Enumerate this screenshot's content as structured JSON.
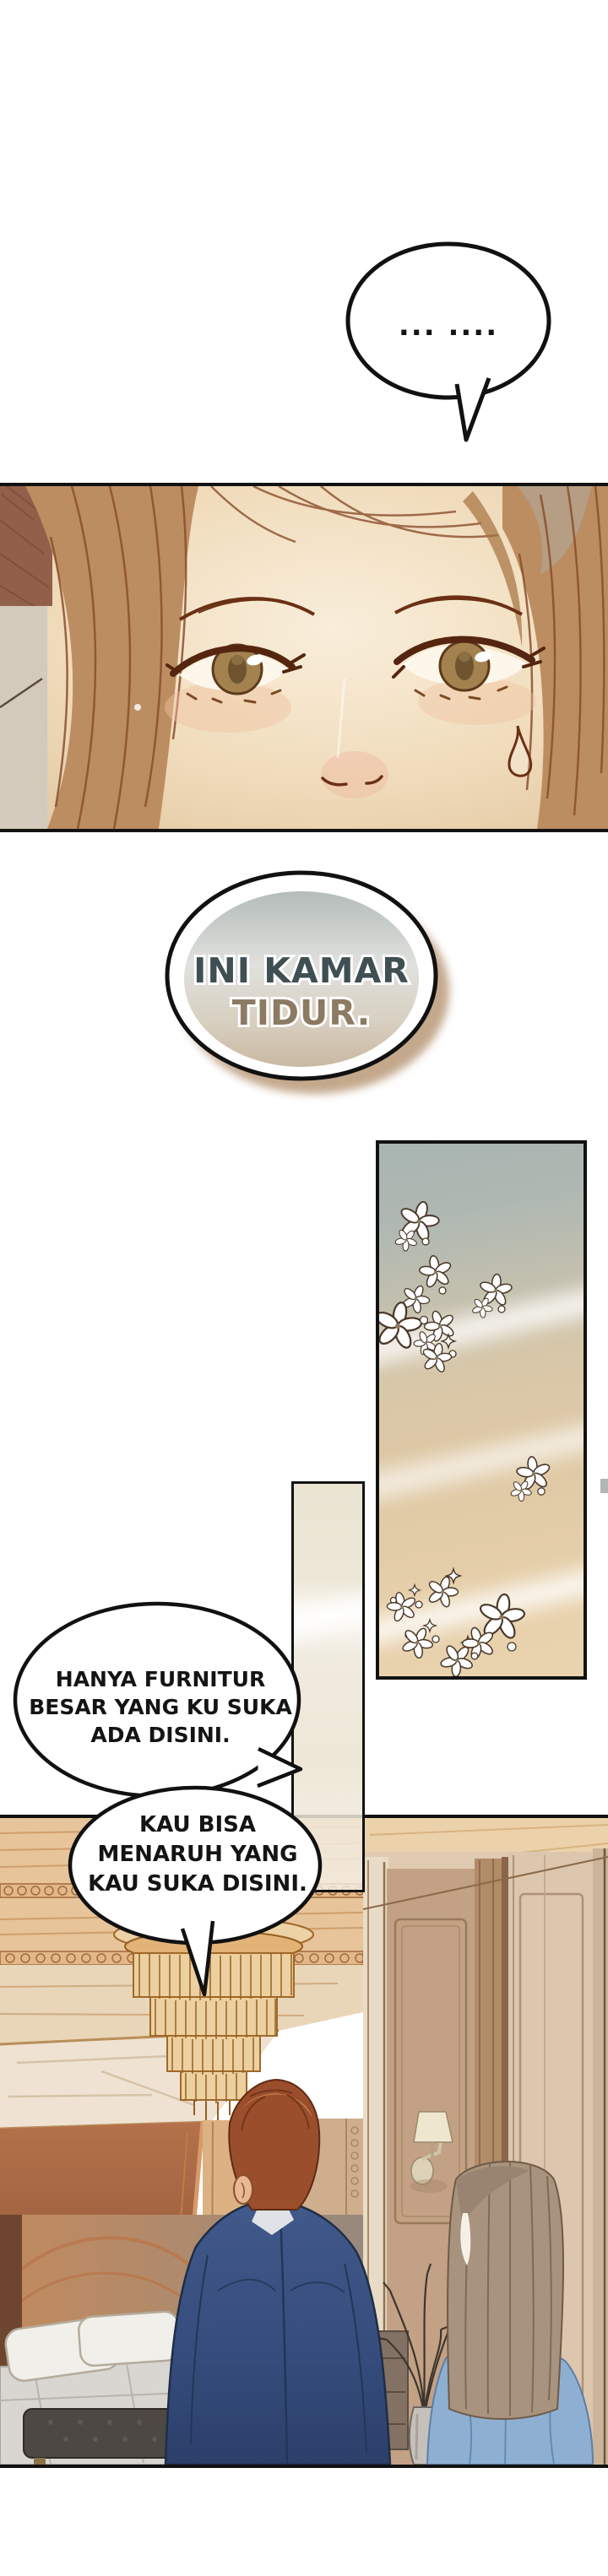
{
  "bubbles": {
    "silence": "... ....",
    "room_label": {
      "line1": "INI KAMAR",
      "line2": "TIDUR."
    },
    "furniture": {
      "line1": "HANYA FURNITUR",
      "line2": "BESAR YANG KU SUKA",
      "line3": "ADA DISINI."
    },
    "offer": {
      "line1": "KAU BISA",
      "line2": "MENARUH YANG",
      "line3": "KAU SUKA DISINI."
    }
  },
  "colors": {
    "page_bg": "#ffffff",
    "panel_border": "#121212",
    "skin": "#f6e8d4",
    "hair_brown": "#bd8d62",
    "suit_navy": "#3c5686",
    "cardigan_blue": "#8db0d2",
    "curtain_blue_gray": "#a9b5b2",
    "curtain_tan": "#e8d0aa",
    "room_tan": "#d8ab7f",
    "chandelier_gold": "#e2b276",
    "label_text_teal": "#3f4f52",
    "label_text_brown": "#8c7a62"
  }
}
